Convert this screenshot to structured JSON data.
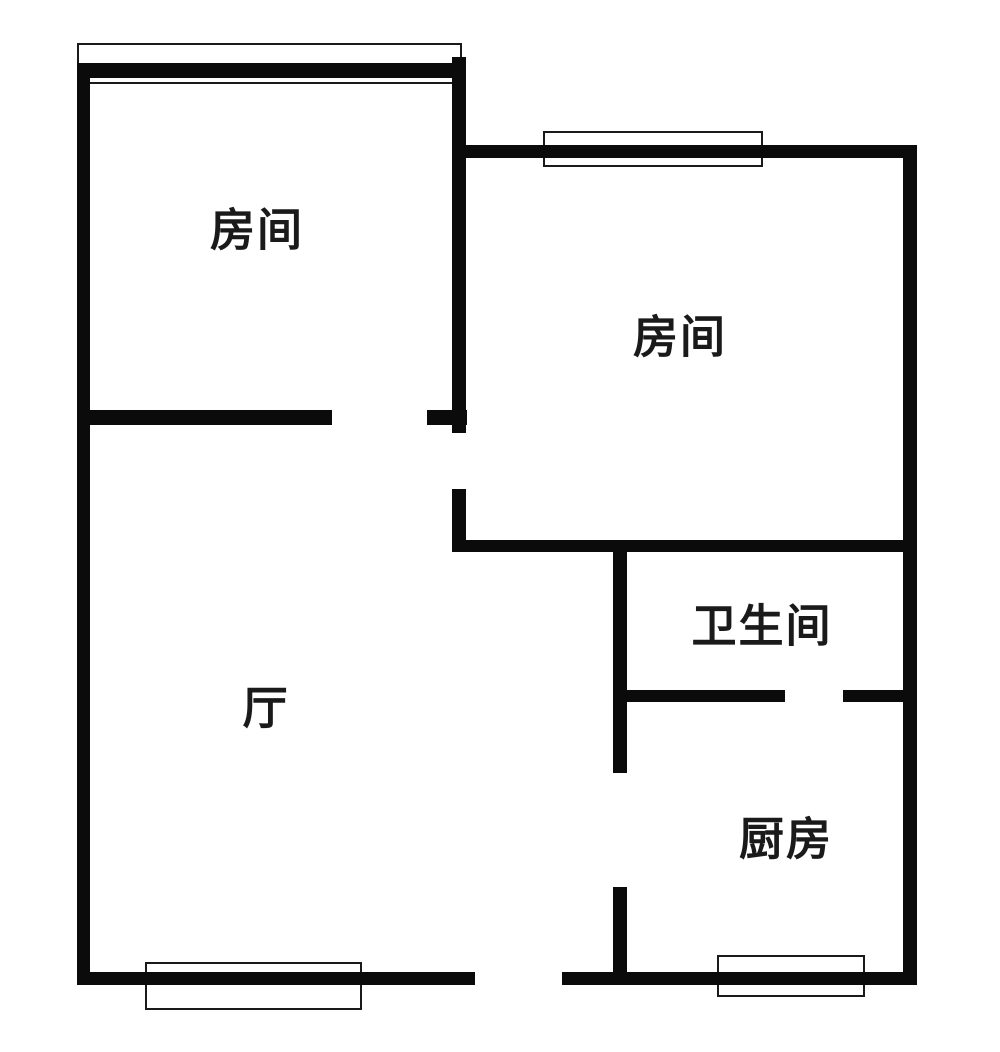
{
  "plan": {
    "canvas": {
      "width": 1000,
      "height": 1052
    },
    "colors": {
      "wall": "#0b0b0b",
      "background": "#ffffff",
      "window_border": "#1a1a1a",
      "label_text": "#1a1a1a"
    },
    "rooms": [
      {
        "id": "bedroom-left",
        "label": "房间",
        "cx": 257,
        "cy": 230
      },
      {
        "id": "bedroom-right",
        "label": "房间",
        "cx": 680,
        "cy": 337
      },
      {
        "id": "bathroom",
        "label": "卫生间",
        "cx": 762,
        "cy": 626
      },
      {
        "id": "living-room",
        "label": "厅",
        "cx": 266,
        "cy": 708
      },
      {
        "id": "kitchen",
        "label": "厨房",
        "cx": 786,
        "cy": 839
      }
    ],
    "walls": [
      {
        "name": "wall-left-outer",
        "x": 77,
        "y": 63,
        "w": 13,
        "h": 922
      },
      {
        "name": "wall-top-bedroom-left",
        "x": 77,
        "y": 63,
        "w": 385,
        "h": 15
      },
      {
        "name": "wall-divider-upper",
        "x": 452,
        "y": 57,
        "w": 14,
        "h": 376
      },
      {
        "name": "wall-divider-lower",
        "x": 452,
        "y": 489,
        "w": 14,
        "h": 63
      },
      {
        "name": "wall-top-bedroom-right",
        "x": 452,
        "y": 145,
        "w": 465,
        "h": 13
      },
      {
        "name": "wall-right-outer",
        "x": 903,
        "y": 145,
        "w": 14,
        "h": 840
      },
      {
        "name": "wall-bedroom-left-hall",
        "x": 77,
        "y": 410,
        "w": 255,
        "h": 15
      },
      {
        "name": "wall-bedroom-left-hall-tick",
        "x": 427,
        "y": 410,
        "w": 40,
        "h": 15
      },
      {
        "name": "wall-bedroom-right-bottom",
        "x": 452,
        "y": 540,
        "w": 465,
        "h": 12
      },
      {
        "name": "wall-bathroom-left",
        "x": 613,
        "y": 552,
        "w": 14,
        "h": 221
      },
      {
        "name": "wall-kitchen-left",
        "x": 613,
        "y": 887,
        "w": 14,
        "h": 98
      },
      {
        "name": "wall-bathroom-bottom-left",
        "x": 627,
        "y": 690,
        "w": 158,
        "h": 12
      },
      {
        "name": "wall-bathroom-bottom-right",
        "x": 843,
        "y": 690,
        "w": 74,
        "h": 12
      },
      {
        "name": "wall-bottom-outer-left",
        "x": 77,
        "y": 972,
        "w": 398,
        "h": 13
      },
      {
        "name": "wall-bottom-outer-right",
        "x": 562,
        "y": 972,
        "w": 355,
        "h": 13
      }
    ],
    "windows": [
      {
        "name": "window-bedroom-left-top",
        "x": 77,
        "y": 43,
        "w": 385,
        "h": 41
      },
      {
        "name": "window-bedroom-right-top",
        "x": 543,
        "y": 131,
        "w": 220,
        "h": 36
      },
      {
        "name": "window-living-room-bottom",
        "x": 145,
        "y": 962,
        "w": 217,
        "h": 48
      },
      {
        "name": "window-kitchen-bottom",
        "x": 717,
        "y": 955,
        "w": 148,
        "h": 42
      }
    ],
    "door_openings": [
      {
        "name": "door-opening-bedroom-left",
        "x": 332,
        "y": 410,
        "w": 95,
        "h": 15
      },
      {
        "name": "door-opening-bedroom-right",
        "x": 452,
        "y": 433,
        "w": 14,
        "h": 56
      },
      {
        "name": "door-opening-bathroom",
        "x": 785,
        "y": 690,
        "w": 58,
        "h": 12
      },
      {
        "name": "door-opening-kitchen",
        "x": 613,
        "y": 773,
        "w": 14,
        "h": 114
      },
      {
        "name": "door-opening-entrance",
        "x": 475,
        "y": 972,
        "w": 87,
        "h": 13
      }
    ]
  }
}
